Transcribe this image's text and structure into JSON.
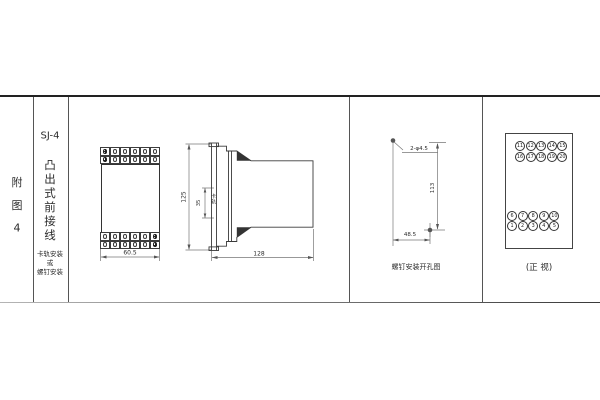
{
  "sidebar": {
    "figure_label_chars": [
      "附",
      "图",
      "4"
    ],
    "model": "SJ-4",
    "type_chars": [
      "凸",
      "出",
      "式",
      "前",
      "接",
      "线"
    ],
    "mount_lines": [
      "卡轨安装",
      "或",
      "螺钉安装"
    ]
  },
  "front_view": {
    "width_dim": "60.5"
  },
  "side_view": {
    "height_dim": "125",
    "rail_dim": "35",
    "rail_label": "卡轨",
    "depth_dim": "128"
  },
  "drill_view": {
    "holes_label": "2-φ4.5",
    "height_dim": "113",
    "width_dim": "48.5",
    "caption": "螺钉安装开孔图"
  },
  "terminal_view": {
    "caption": "(正 视)",
    "top_rows": [
      [
        "11",
        "12",
        "13",
        "14",
        "15"
      ],
      [
        "16",
        "17",
        "18",
        "19",
        "20"
      ]
    ],
    "bottom_rows": [
      [
        "6",
        "7",
        "8",
        "9",
        "10"
      ],
      [
        "1",
        "2",
        "3",
        "4",
        "5"
      ]
    ]
  },
  "colors": {
    "object_line": "#3a3a3a",
    "dim_line": "#777",
    "border_dark": "#222"
  }
}
